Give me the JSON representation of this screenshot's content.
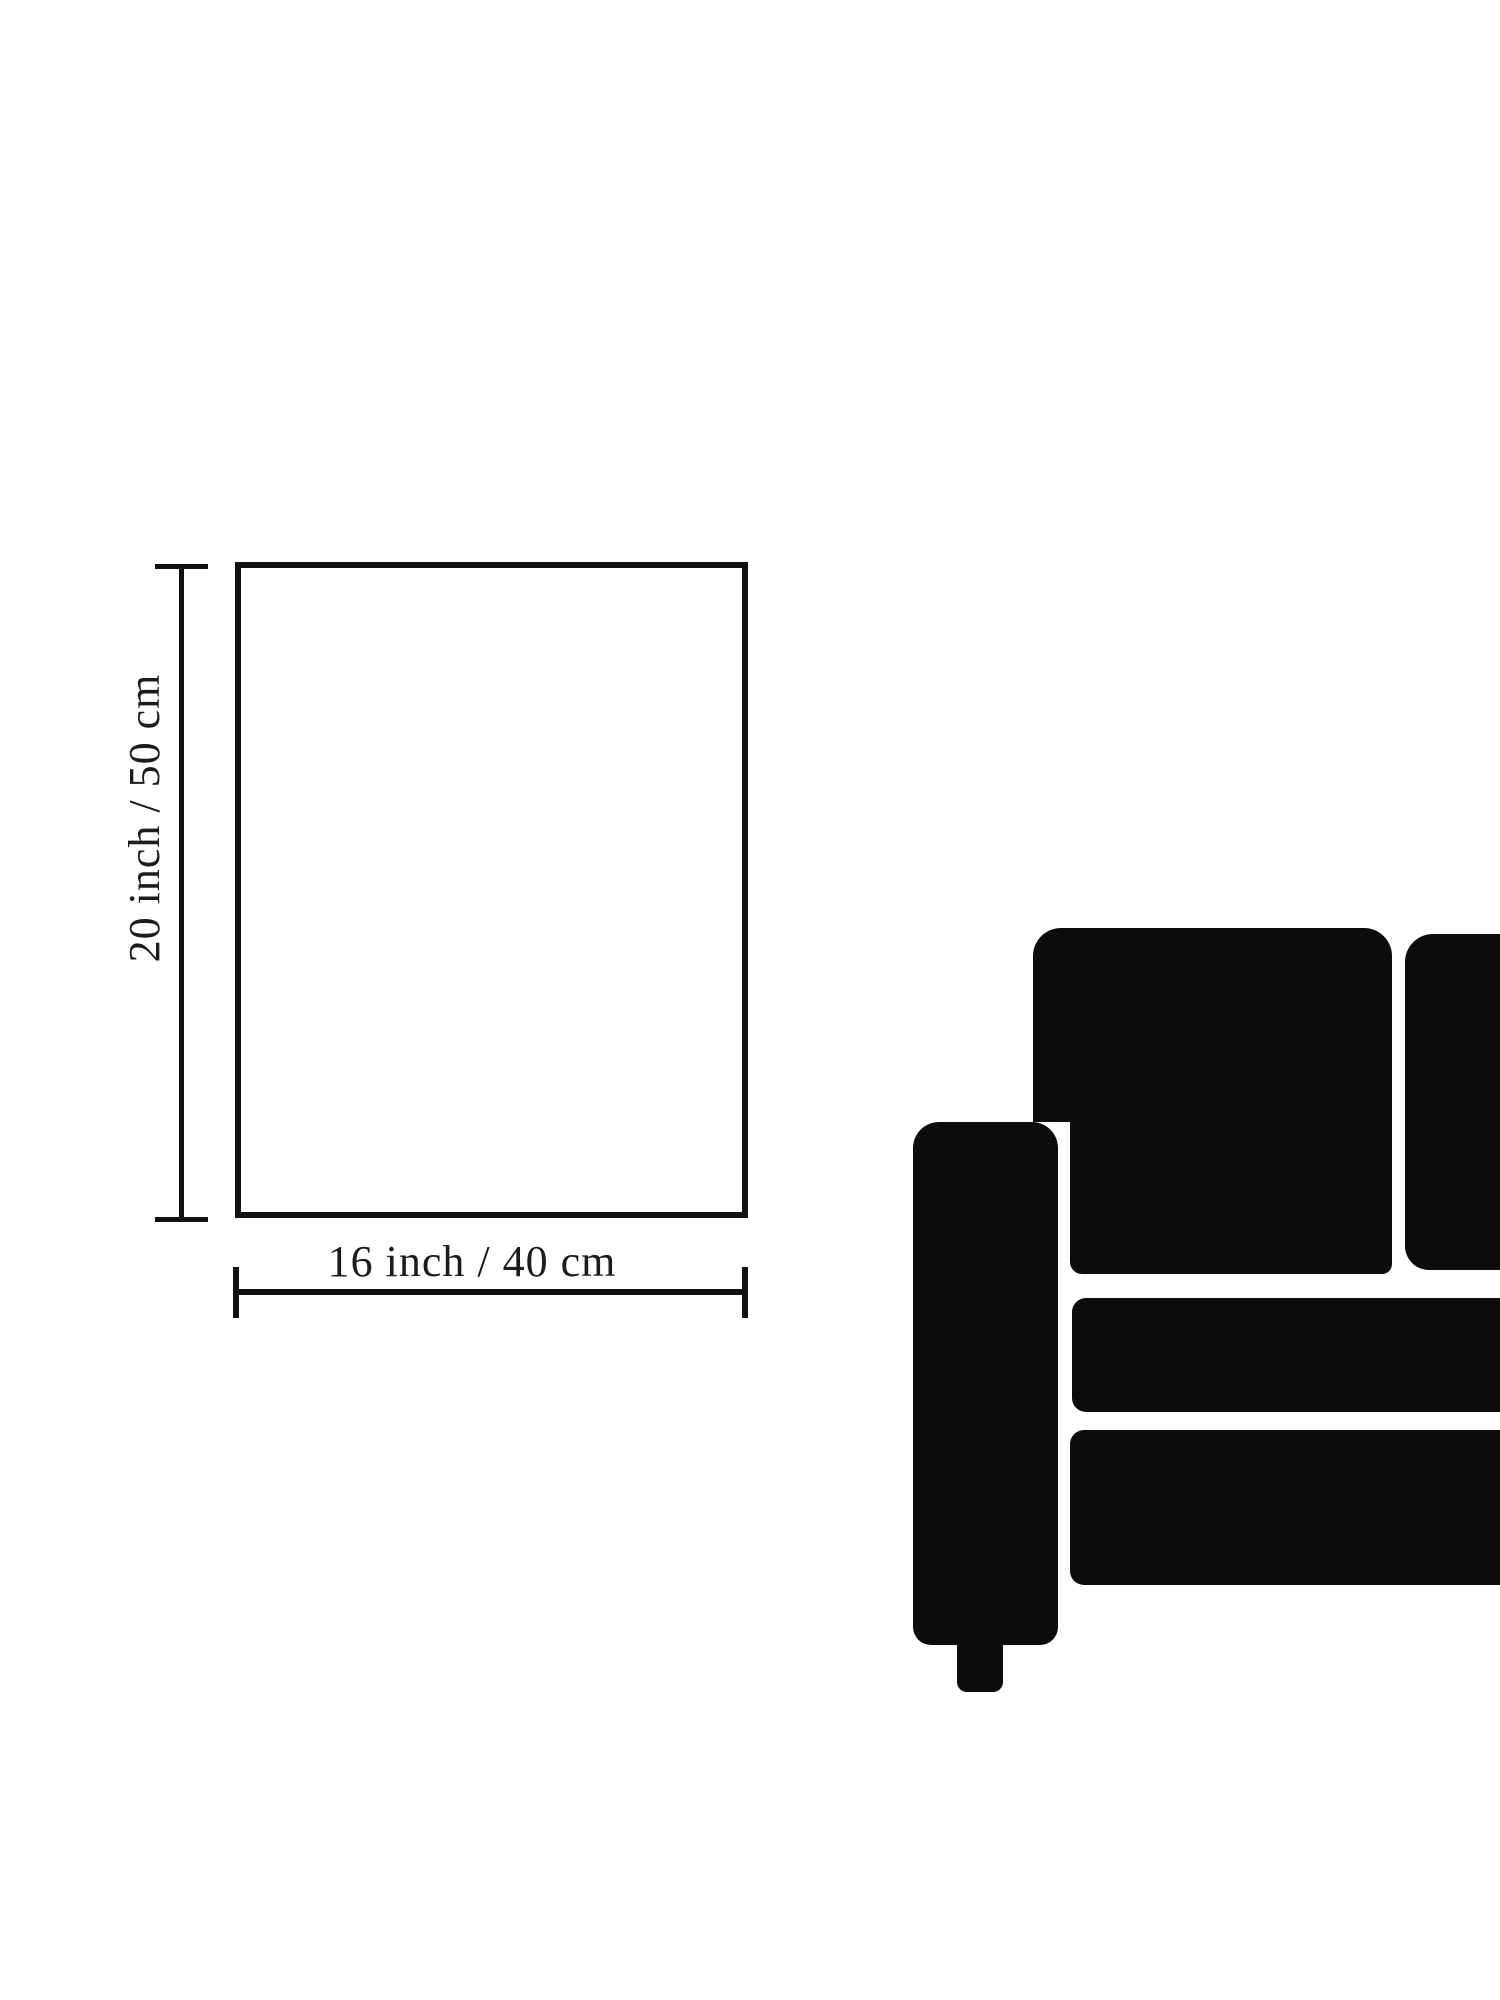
{
  "figure": {
    "type": "product-size-diagram",
    "vertical_dimension": {
      "label": "20 inch / 50 cm"
    },
    "horizontal_dimension": {
      "label": "16 inch / 40 cm"
    }
  },
  "icons": {
    "sofa": "sofa-silhouette"
  },
  "colors": {
    "ink": "#0c0c0c",
    "line": "#111111",
    "label_text": "#1c1c1c",
    "background": "#ffffff"
  }
}
